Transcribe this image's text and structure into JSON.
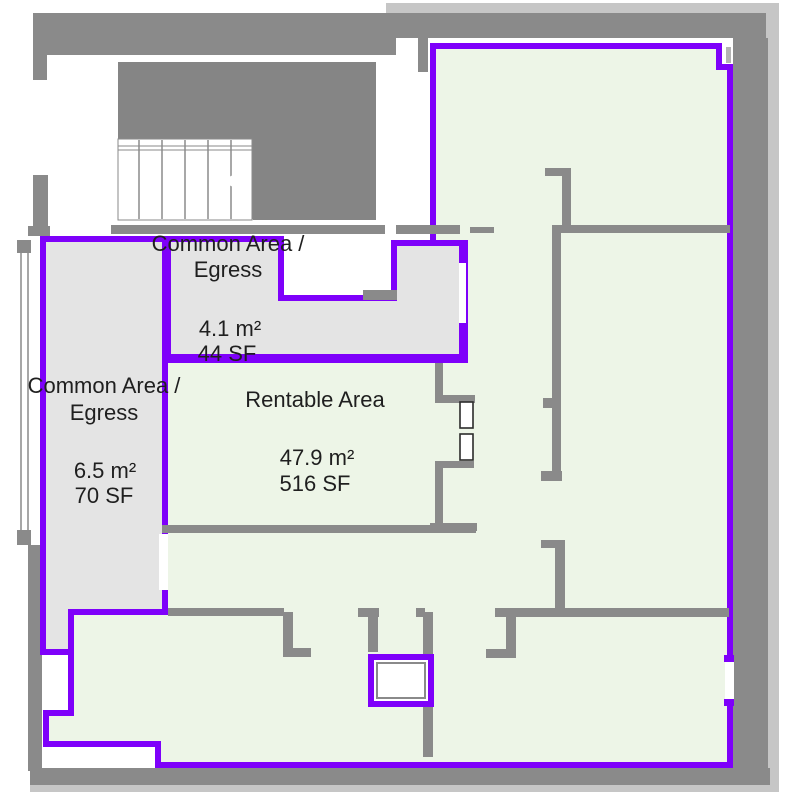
{
  "title": "Floor plan with rentable and common area takeoff",
  "colors": {
    "area_outline_purple": "#7E00FA",
    "rentable_fill_green": "#EDF5E7",
    "common_fill_gray": "#E4E4E4",
    "wall_gray": "#8A8A8A",
    "wall_light_gray": "#C6C6C6",
    "label_text": "#1F1F1F",
    "background": "#FFFFFF"
  },
  "areas": {
    "common_top": {
      "name_line1": "Common Area /",
      "name_line2": "Egress",
      "metric": "4.1 m²",
      "imperial": "44 SF"
    },
    "common_left": {
      "name_line1": "Common Area /",
      "name_line2": "Egress",
      "metric": "6.5 m²",
      "imperial": "70 SF"
    },
    "rentable": {
      "name": "Rentable Area",
      "metric": "47.9 m²",
      "imperial": "516 SF"
    }
  }
}
